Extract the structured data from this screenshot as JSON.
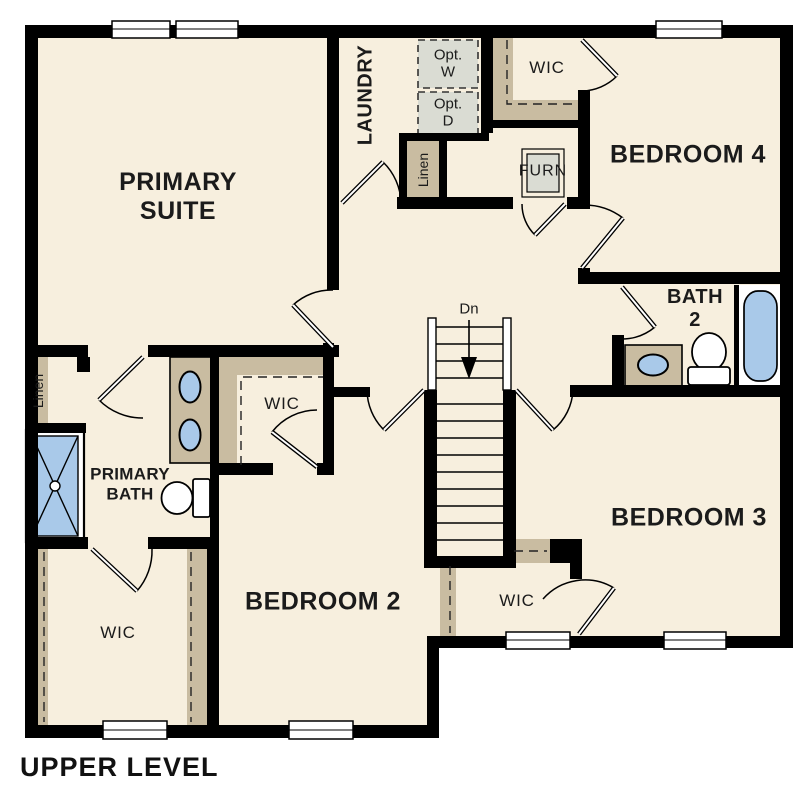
{
  "plan_title": "UPPER LEVEL",
  "rooms": {
    "primary_suite": "PRIMARY\nSUITE",
    "laundry": "LAUNDRY",
    "bedroom_4": "BEDROOM 4",
    "bath_2": "BATH\n2",
    "bedroom_3": "BEDROOM 3",
    "bedroom_2": "BEDROOM 2",
    "primary_bath": "PRIMARY\nBATH",
    "wic_top": "WIC",
    "wic_middle": "WIC",
    "wic_bottom_left": "WIC",
    "wic_bottom_right": "WIC"
  },
  "closets": {
    "linen_laundry": "Linen",
    "linen_primary": "Linen"
  },
  "equipment": {
    "optional_washer": "Opt.\nW",
    "optional_dryer": "Opt.\nD",
    "furnace": "FURN"
  },
  "stairs": {
    "direction": "Dn"
  },
  "colors": {
    "floor": "#f7efde",
    "wall": "#000000",
    "closet_shelf": "#c9bca1",
    "equipment_gray": "#dadcd3",
    "fixture_blue": "#a9c9e9",
    "background": "#ffffff",
    "text": "#1b1b1b"
  }
}
